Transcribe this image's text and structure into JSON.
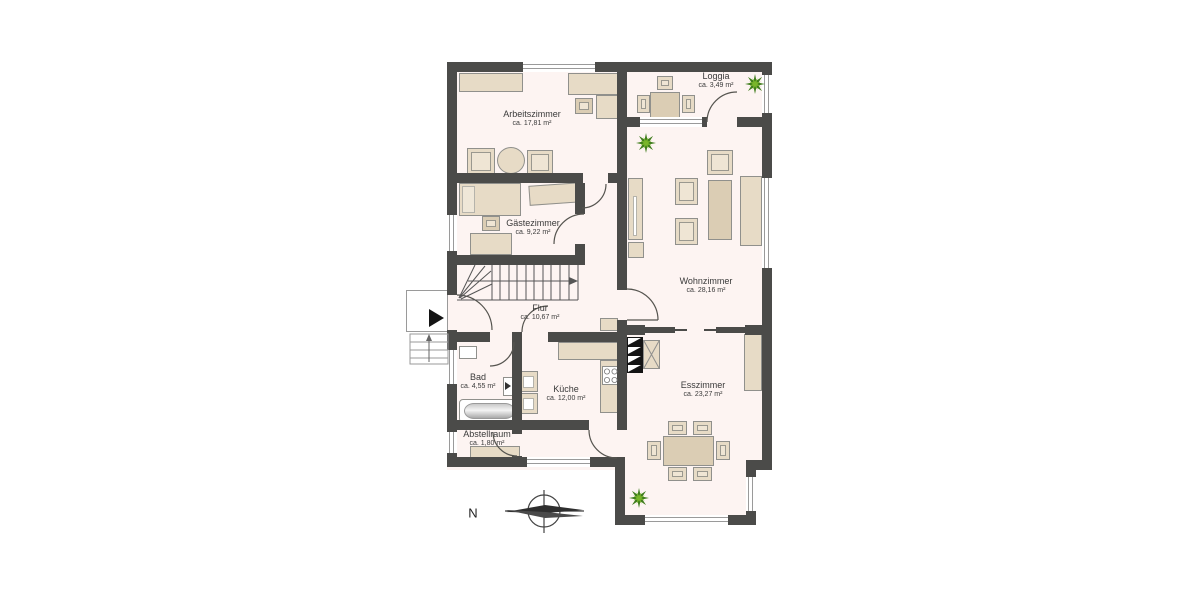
{
  "rooms": [
    {
      "name": "Arbeitszimmer",
      "area": "ca. 17,81 m²"
    },
    {
      "name": "Loggia",
      "area": "ca. 3,49 m²"
    },
    {
      "name": "Gästezimmer",
      "area": "ca. 9,22 m²"
    },
    {
      "name": "Wohnzimmer",
      "area": "ca. 28,16 m²"
    },
    {
      "name": "Flur",
      "area": "ca. 10,67 m²"
    },
    {
      "name": "Bad",
      "area": "ca. 4,55 m²"
    },
    {
      "name": "Küche",
      "area": "ca. 12,00 m²"
    },
    {
      "name": "Esszimmer",
      "area": "ca. 23,27 m²"
    },
    {
      "name": "Abstellraum",
      "area": "ca. 1,80 m²"
    }
  ],
  "compass": {
    "label": "N"
  },
  "colors": {
    "wall": "#4b4b49",
    "floor": "#fdf4f2",
    "furniture": "#e7dbc6",
    "furniture_dark": "#dbcdb4",
    "plant_dark": "#3f7d1c",
    "plant_light": "#79b62a"
  }
}
